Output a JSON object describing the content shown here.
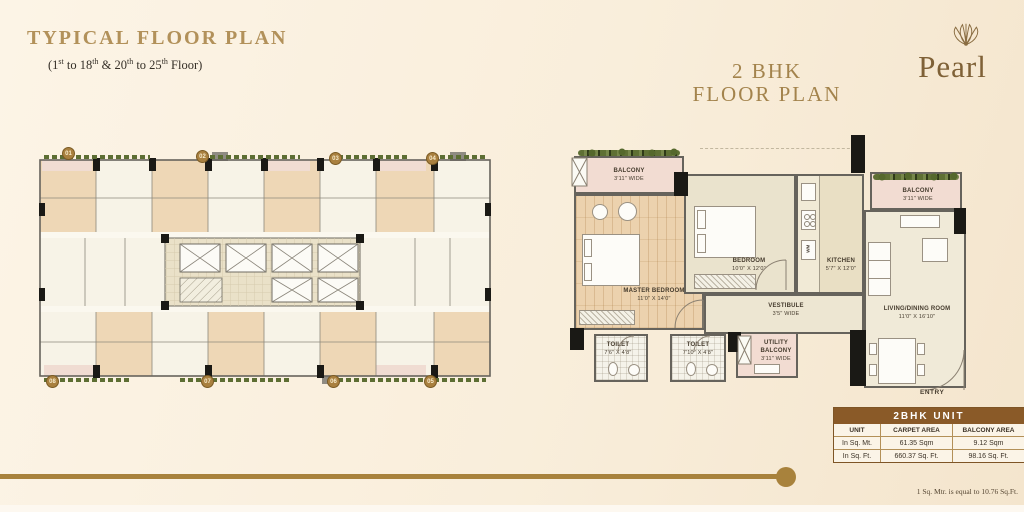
{
  "page": {
    "title": "TYPICAL FLOOR PLAN",
    "subtitle": {
      "p1": "(1",
      "s1": "st",
      "p2": " to 18",
      "s2": "th",
      "p3": " & 20",
      "s3": "th",
      "p4": " to 25",
      "s4": "th",
      "p5": " Floor)"
    },
    "footnote": "1 Sq. Mtr. is equal to 10.76 Sq.Ft."
  },
  "brand": {
    "name": "Pearl",
    "logo_icon": "shell-icon"
  },
  "bhk_header": {
    "line1": "2 BHK",
    "line2": "FLOOR PLAN"
  },
  "typical_plan": {
    "units_top": [
      "01",
      "02",
      "03",
      "04"
    ],
    "units_bottom": [
      "08",
      "07",
      "06",
      "05"
    ]
  },
  "bhk_plan": {
    "rooms": {
      "balcony_tl": {
        "name": "BALCONY",
        "dims": "3'11\" WIDE"
      },
      "master_bedroom": {
        "name": "MASTER BEDROOM",
        "dims": "11'0\" X 14'0\""
      },
      "bedroom": {
        "name": "BEDROOM",
        "dims": "10'0\" X 12'0\""
      },
      "kitchen": {
        "name": "KITCHEN",
        "dims": "5'7\" X 12'0\""
      },
      "balcony_tr": {
        "name": "BALCONY",
        "dims": "3'11\" WIDE"
      },
      "living_dining": {
        "name": "LIVING/DINING ROOM",
        "dims": "11'0\" X 16'10\""
      },
      "vestibule": {
        "name": "VESTIBULE",
        "dims": "3'5\" WIDE"
      },
      "toilet_1": {
        "name": "TOILET",
        "dims": "7'6\" X 4'8\""
      },
      "toilet_2": {
        "name": "TOILET",
        "dims": "7'10\" X 4'8\""
      },
      "utility_balcony": {
        "name": "UTILITY BALCONY",
        "dims": "3'11\" WIDE"
      }
    },
    "labels": {
      "entry": "ENTRY",
      "wm": "WM"
    }
  },
  "area_table": {
    "title": "2BHK UNIT",
    "headers": [
      "UNIT",
      "CARPET AREA",
      "BALCONY AREA"
    ],
    "rows": [
      [
        "In Sq. Mt.",
        "61.35 Sqm",
        "9.12 Sqm"
      ],
      [
        "In Sq. Ft.",
        "660.37 Sq. Ft.",
        "98.16 Sq. Ft."
      ]
    ]
  },
  "colors": {
    "accent_gold": "#a8823c",
    "table_header_bg": "#8a5a28",
    "wall": "#66635c",
    "column": "#1a1915"
  }
}
